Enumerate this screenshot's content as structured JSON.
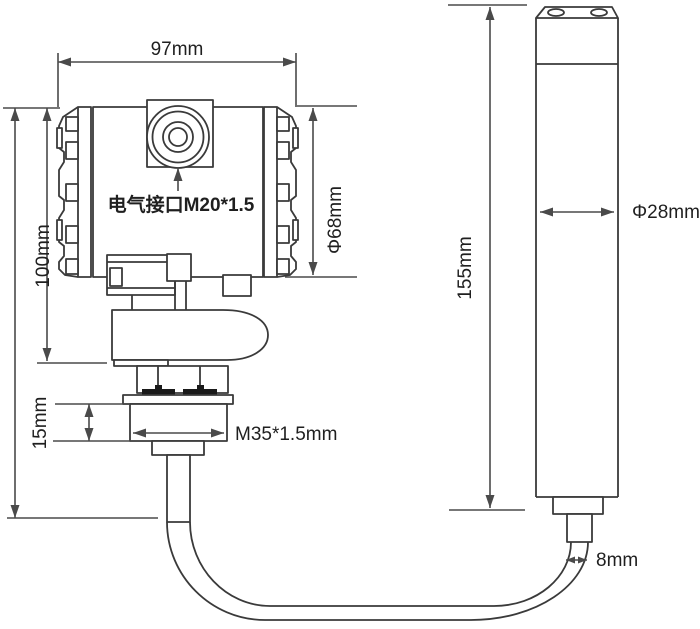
{
  "colors": {
    "background": "#ffffff",
    "outline": "#3a3a3a",
    "dimension": "#4a4a4a",
    "text": "#1f1f1f",
    "seal": "#1a1a1a"
  },
  "transmitter": {
    "width_dim": "97mm",
    "height_dim": "100mm",
    "housing_diameter_dim": "Φ68mm",
    "thread_length_dim": "15mm",
    "mounting_thread_dim": "M35*1.5mm",
    "electrical_port_label": "电气接口M20*1.5"
  },
  "probe": {
    "length_dim": "155mm",
    "diameter_dim": "Φ28mm",
    "cable_diameter_dim": "8mm"
  }
}
